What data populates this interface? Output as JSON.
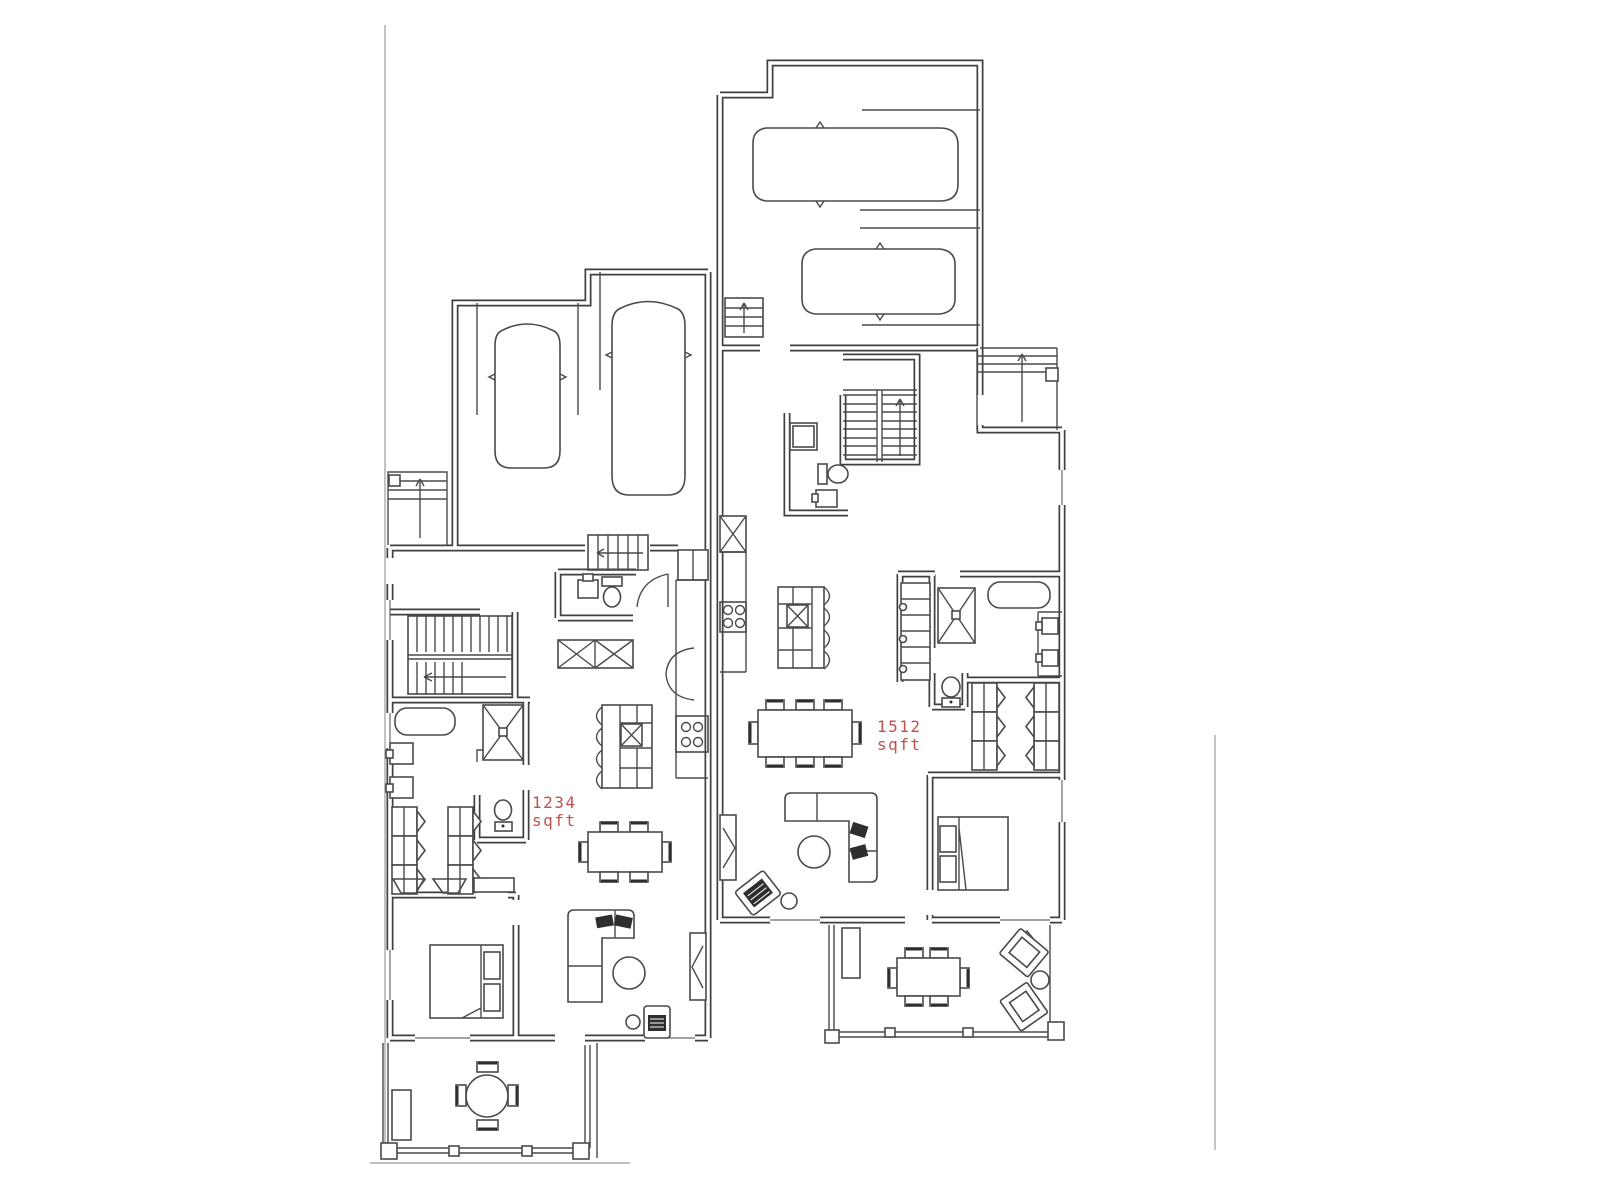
{
  "colors": {
    "line": "#3f3f3f",
    "furniture": "#4a4a4a",
    "dark": "#2e2e2e",
    "label": "#c0504d",
    "lot": "#9b9b9b",
    "background": "#ffffff"
  },
  "labels": {
    "unit_a": {
      "area": "1234",
      "unit": "sqft"
    },
    "unit_b": {
      "area": "1512",
      "unit": "sqft"
    }
  }
}
